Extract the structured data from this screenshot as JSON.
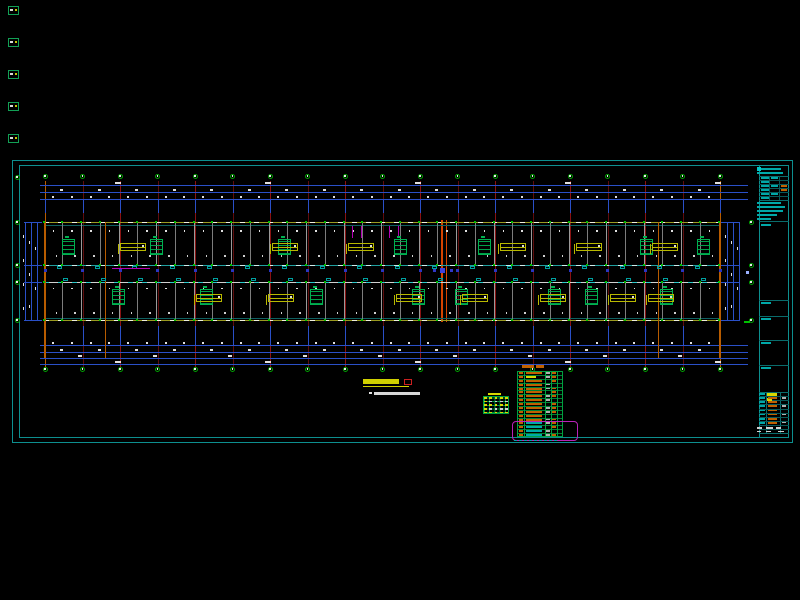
{
  "scene": {
    "w": 800,
    "h": 600,
    "bg": "#000000"
  },
  "colors": {
    "frame": "#0d8f8f",
    "frame_dim": "#0a6c6c",
    "dim_blue": "#2a50c8",
    "grid_red": "#8a1212",
    "grid_red_dim": "#5e0d0d",
    "grid_orange": "#b85c00",
    "joint_orange": "#d84400",
    "bubble_green": "#00a000",
    "dot_green": "#00c000",
    "wall_olive": "#9a9a20",
    "wall_cyan": "#20a0a0",
    "wall_white": "#d0d0d0",
    "partition_gray": "#9a9a9a",
    "stair_green": "#00b050",
    "bench_yellow": "#b8b800",
    "magenta": "#b400b4",
    "door_cyan": "#00a0a0",
    "speck_white": "#e0e0e0",
    "table_green": "#00a040",
    "text_orange": "#c06000",
    "text_cyan": "#00a8a8",
    "text_yellow": "#d8d800",
    "highlight_magenta": "#b822b8",
    "title_yellow": "#d0d000",
    "scale_red": "#cc2020"
  },
  "frame": {
    "outer": {
      "x": 12,
      "y": 160,
      "w": 781,
      "h": 283
    },
    "inner": {
      "x": 19,
      "y": 165,
      "w": 770,
      "h": 273
    },
    "titleblock_x": 759
  },
  "left_glyphs": {
    "x": 8,
    "ys": [
      6,
      38,
      70,
      102,
      134
    ],
    "w": 11,
    "h": 9
  },
  "grid": {
    "x0": 45,
    "x1": 720,
    "mains": 19,
    "y0": 181,
    "y1": 367,
    "joint_xs": [
      441,
      445.5
    ],
    "corner_bubble": {
      "x": 17,
      "y": 177
    }
  },
  "bubbles": {
    "top_y": 176,
    "bottom_y": 369,
    "d": 5,
    "left_x": 17,
    "right_x": 751,
    "side_ys": [
      222,
      265,
      282,
      320
    ]
  },
  "dims": {
    "top_ys": [
      185,
      192,
      199
    ],
    "bottom_ys": [
      345,
      352,
      358,
      364
    ],
    "x0": 40,
    "x1": 748,
    "left_xs": [
      25,
      31,
      37
    ],
    "right_xs": [
      727,
      733,
      739
    ],
    "ext_top": [
      199,
      213
    ],
    "ext_bottom": [
      326,
      345
    ]
  },
  "building": {
    "x0": 43.5,
    "x1": 720,
    "top_band": {
      "y": 222,
      "h": 43
    },
    "corridor": {
      "y": 265,
      "h": 17
    },
    "bottom_band": {
      "y": 282,
      "h": 38
    },
    "end_wall_xs": [
      105,
      658
    ],
    "partition_step": 18.75
  },
  "stairs": {
    "w": 13,
    "h": 16,
    "top_y": 239,
    "top_xs": [
      62,
      150,
      278,
      394,
      478,
      640,
      697
    ],
    "bottom_y": 289,
    "bottom_xs": [
      112,
      200,
      310,
      412,
      455,
      548,
      585,
      660
    ]
  },
  "benches": {
    "w": 26,
    "h": 8,
    "top_y": 243,
    "top_xs": [
      120,
      272,
      348,
      500,
      576,
      652
    ],
    "bottom_y": 294,
    "bottom_xs": [
      196,
      268,
      396,
      462,
      540,
      610,
      648
    ]
  },
  "magenta_marks": {
    "top_tick_xs": [
      352,
      361,
      389,
      398
    ],
    "top_tick_y": 226,
    "tick_h": 12,
    "corridor_bar": {
      "x": 112,
      "y": 267.5,
      "w": 38
    }
  },
  "doors": {
    "offset": 12,
    "top_y": 266,
    "bottom_y": 277.5,
    "w": 5,
    "h": 3
  },
  "corridor_marks": {
    "y": 268.5,
    "s": 3
  },
  "annotations": {
    "title_bar": {
      "x": 363,
      "y": 379,
      "w": 36,
      "h": 4.5
    },
    "underline": {
      "x": 363,
      "y": 385.5,
      "w": 46
    },
    "scale_box": {
      "x": 404,
      "y": 378.5,
      "w": 8,
      "h": 6
    },
    "note_dot": {
      "x": 369,
      "y": 391.5,
      "s": 2.5
    },
    "note_bar": {
      "x": 374,
      "y": 392,
      "w": 46,
      "h": 2.5
    },
    "right_label": {
      "x": 744,
      "y": 321,
      "w": 6,
      "h": 2
    },
    "right_square": {
      "x": 746,
      "y": 271,
      "s": 3
    }
  },
  "green_table": {
    "x": 483,
    "y": 396,
    "w": 26,
    "h": 18,
    "rows": 5,
    "cols": 5,
    "title": {
      "x": 488,
      "y": 392.5,
      "w": 13,
      "h": 2.5
    }
  },
  "orange_table": {
    "x": 517,
    "y": 371,
    "w": 46,
    "h": 66,
    "rows": 17,
    "col_offsets": [
      7,
      28,
      34,
      40
    ],
    "cyan_from_row": 13,
    "title_bars": [
      [
        522,
        365,
        12,
        3
      ],
      [
        536,
        365,
        8,
        3
      ]
    ]
  },
  "magenta_box": {
    "x": 512,
    "y": 420.5,
    "w": 66,
    "h": 20
  },
  "cyan_caption": {
    "x": 514,
    "y": 439.5,
    "w": 44,
    "h": 1.5
  },
  "titleblock": {
    "x0": 759,
    "x1": 789,
    "y0": 165,
    "y1": 437,
    "hlines": [
      175.5,
      200,
      221,
      300,
      316,
      340,
      365,
      392,
      433
    ],
    "mini_table": {
      "y0": 176,
      "y1": 200,
      "rows": 6,
      "vxs": [
        769,
        779
      ]
    },
    "header_bars": [
      [
        761,
        167.5,
        20
      ],
      [
        757,
        171.5,
        26
      ]
    ],
    "logo_box": {
      "x": 757,
      "y": 167,
      "s": 3.5
    },
    "text_bars": [
      [
        757,
        202,
        24
      ],
      [
        757,
        206,
        28
      ],
      [
        757,
        210,
        26
      ],
      [
        757,
        214,
        20
      ],
      [
        757,
        218,
        14
      ]
    ],
    "cell_label_ys": [
      224,
      302,
      318,
      342,
      367
    ],
    "bottom_table": {
      "y0": 392,
      "y1": 433,
      "rows": 8,
      "vxs": [
        766,
        780
      ],
      "header_yellow": [
        767,
        393,
        10,
        2.5
      ],
      "yellow_cell": [
        767,
        397.5,
        5,
        3
      ],
      "footer_bars": [
        [
          757,
          427,
          5,
          2
        ],
        [
          766,
          427,
          7,
          2
        ],
        [
          776,
          427,
          5,
          2
        ],
        [
          757,
          430.5,
          4,
          1.8
        ],
        [
          766,
          430.5,
          5,
          1.8
        ],
        [
          778,
          430.5,
          6,
          1.8
        ]
      ]
    }
  }
}
